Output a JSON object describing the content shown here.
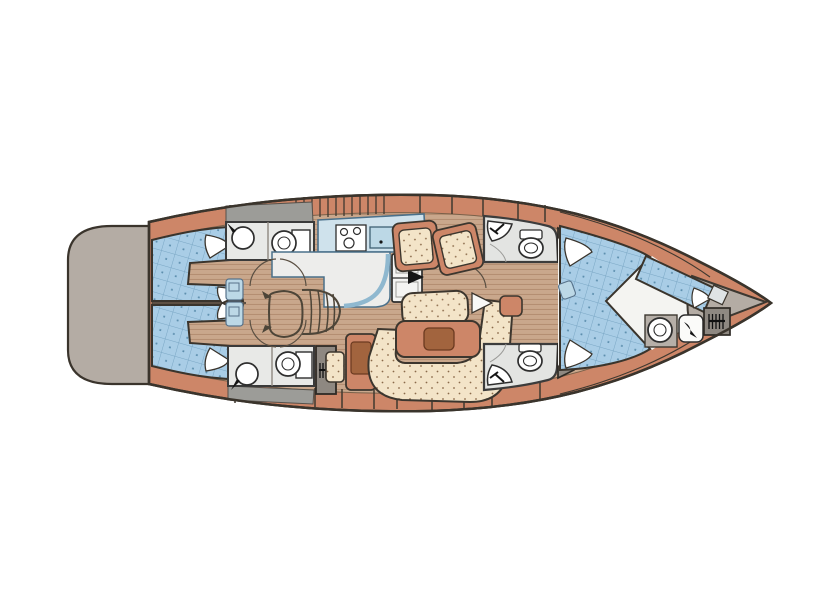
{
  "diagram": {
    "type": "yacht-interior-floor-plan",
    "orientation": "bow-right-stern-left",
    "features": [
      "swim-platform",
      "twin-aft-double-cabins",
      "aft-head-port",
      "aft-head-starboard",
      "galley-with-stove-sink-fridge",
      "companionway-stairs",
      "engine-box",
      "nav-station",
      "salon-armchairs",
      "salon-center-bench",
      "salon-table",
      "u-shaped-settee",
      "forward-head-port",
      "forward-head-starboard",
      "hanging-lockers",
      "forward-owner-cabin-double-bed",
      "bow-crew-berth",
      "bow-head-toilet-sink",
      "anchor-windlass",
      "bow-locker"
    ]
  },
  "colors": {
    "background": "#ffffff",
    "hull": "#cd8668",
    "hull_outline": "#3a342c",
    "deck_gray": "#b4aca4",
    "wall_gray": "#8e8881",
    "strip_gray": "#9c9c98",
    "floor_wood": "#c9a78c",
    "floor_wood_line": "#b08a6d",
    "bed_blue": "#a9cde6",
    "bed_grid": "#79a6c4",
    "bed_dot": "#5d8fae",
    "upholstery_cream": "#f3e4c8",
    "upholstery_dot": "#8a6a4a",
    "counter_white": "#ededeb",
    "bath_floor": "#e8e9e7",
    "galley_blue": "#cfe2ec",
    "galley_sink_blue": "#bcd8e6",
    "galley_edge": "#4a708a",
    "white_floor": "#f4f4f1",
    "fixture_white": "#ffffff",
    "table_wood": "#a2643e",
    "table_wood_edge": "#6b3a20",
    "pillow_white": "#ffffff",
    "door_arc": "#5a4f42",
    "symbol_black": "#151515"
  }
}
